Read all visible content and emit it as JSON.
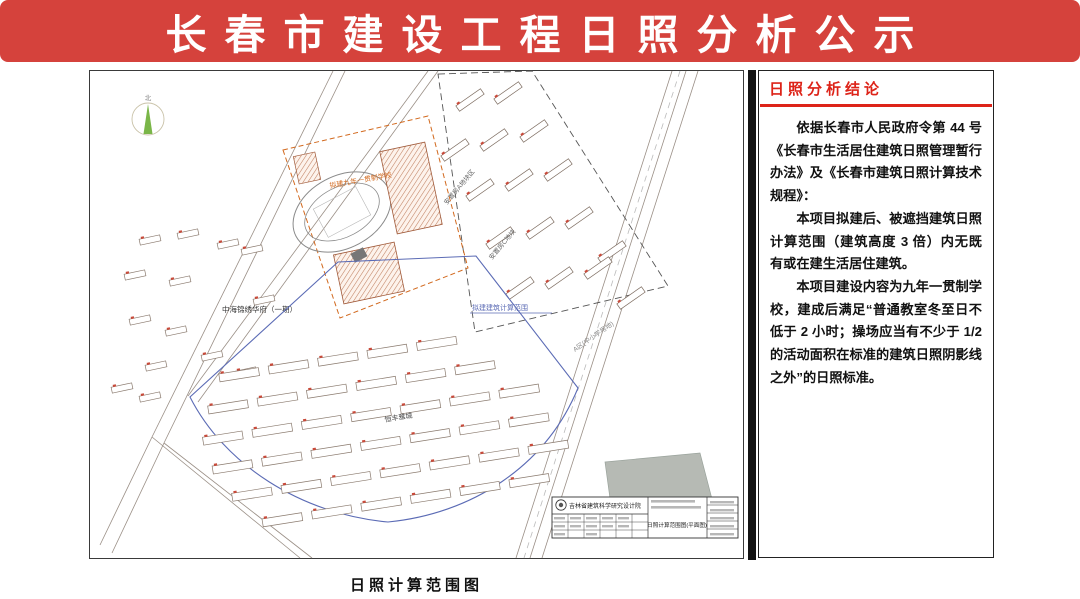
{
  "banner": {
    "title": "长春市建设工程日照分析公示"
  },
  "colors": {
    "banner_red": "#d5423c",
    "accent_red": "#dd2318",
    "calc_range_blue": "#5b6bb5",
    "site_orange": "#d2691e",
    "compass_green": "#7ab648"
  },
  "map": {
    "caption": "日照计算范围图",
    "compass_label": "北",
    "labels": {
      "project_site": "拟建九年一贯制学校",
      "calc_range": "拟建建筑计算范围",
      "west_estate": "中海锦绣华府（一期）",
      "south_estate": "恒丰雅城",
      "plot_a": "安置房A地块区",
      "plot_c": "安置房C地块",
      "school_plot": "A区(中小学用地)"
    },
    "title_block": {
      "institute": "吉林省建筑科学研究设计院",
      "drawing_title": "日照计算范围图(平面图)"
    }
  },
  "panel": {
    "header": "日照分析结论",
    "paragraphs": [
      "依据长春市人民政府令第 44 号《长春市生活居住建筑日照管理暂行办法》及《长春市建筑日照计算技术规程》：",
      "本项目拟建后、被遮挡建筑日照计算范围（建筑高度 3 倍）内无既有或在建生活居住建筑。",
      "本项目建设内容为九年一贯制学校，建成后满足“普通教室冬至日不低于 2 小时；操场应当有不少于 1/2 的活动面积在标准的建筑日照阴影线之外”的日照标准。"
    ]
  }
}
